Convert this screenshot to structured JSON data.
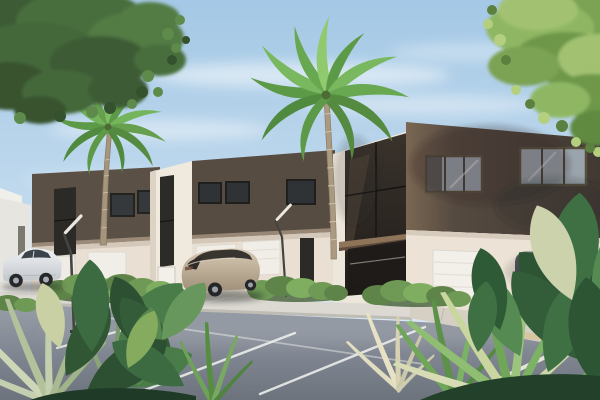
{
  "meta": {
    "kind": "3d-architectural-exterior-rendering",
    "subject": "modern two-story townhouse row on a tropical street",
    "time_of_day": "daytime, clear sky"
  },
  "scene": {
    "description": "Photorealistic daytime rendering of a row of modern flat-roof two-story townhouses with dark brown upper facades, cream lower walls and white garage doors. A gray asphalt parking street with white stall lines runs in front. Two royal palms stand before the facades, leafy tree canopies overhang the top corners, three cars are parked (white SUV at left, champagne crossover at center, dark gray SUV at right on a driveway), and lush tropical plants frame the bottom foreground.",
    "sky": {
      "condition": "clear with thin wispy clouds",
      "color_top": "#a9cbe6",
      "color_horizon": "#e0edf6"
    },
    "lighting": "bright sunlight from the left with soft shadows and tree-shadow dapples on the right facade"
  },
  "buildings": {
    "style": "modern flat-roof townhomes",
    "visible_units": "about six attached units receding to the left",
    "upper_facade_color": "#564b41",
    "lower_facade_color": "#e9e0d3",
    "garage_door_color": "#f1eee8",
    "window_glass_color": "#33373a",
    "atrium": "two-story bronze-glass entry wall with brown canopy slab",
    "street_lamps": 2
  },
  "vehicles": [
    {
      "name": "white-suv",
      "description": "white compact SUV parked at the left, side view facing left",
      "body_color": "#e9ecef",
      "position": "left"
    },
    {
      "name": "champagne-crossover",
      "description": "champagne/beige crossover SUV seen from rear three-quarter",
      "body_color": "#c2b29c",
      "position": "center"
    },
    {
      "name": "dark-suv",
      "description": "dark gray SUV parked on the driveway, rear view",
      "body_color": "#3a3d41",
      "position": "right"
    }
  ],
  "vegetation": {
    "palms": [
      {
        "name": "palm-left",
        "description": "royal palm in front of the left townhouses"
      },
      {
        "name": "palm-center",
        "description": "taller royal palm in front of the middle townhouses"
      }
    ],
    "tree_canopies": [
      {
        "name": "canopy-top-left",
        "color": "#46693c",
        "description": "dark green overhanging branch and leaves, top-left corner"
      },
      {
        "name": "canopy-top-right",
        "color": "#8fb763",
        "description": "light yellow-green overhanging leaves, top-right corner"
      }
    ],
    "hedges": "low trimmed green shrubs along the sidewalk",
    "foreground": "tropical broad-leaf plants and pale palm fronds across the bottom corners"
  },
  "road": {
    "surface": "gray asphalt parking street",
    "asphalt_color": "#858b95",
    "markings": "white diagonal parking stall lines",
    "marking_color": "#f2f3f1",
    "sidewalk_color": "#dcd9d2",
    "driveway": "light concrete driveway apron at the right with tan strip"
  }
}
